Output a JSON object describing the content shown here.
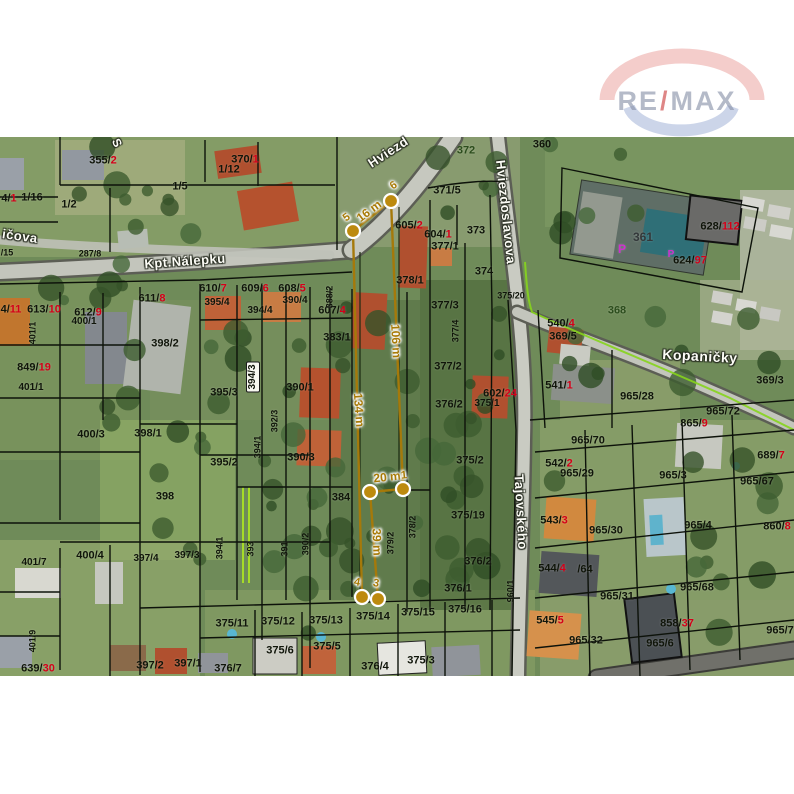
{
  "watermark": {
    "re": "RE",
    "slash": "/",
    "max": "MAX"
  },
  "map": {
    "street_labels": [
      {
        "t": "Kpt.Nálepku",
        "x": 185,
        "y": 261,
        "rot": -4,
        "fs": 13
      },
      {
        "t": "Hviezd",
        "x": 388,
        "y": 152,
        "rot": -33,
        "fs": 13
      },
      {
        "t": "Hviezdoslavova",
        "x": 506,
        "y": 212,
        "rot": 84,
        "fs": 13
      },
      {
        "t": "Tajovského",
        "x": 521,
        "y": 512,
        "rot": 87,
        "fs": 13
      },
      {
        "t": "Kopaničky",
        "x": 700,
        "y": 356,
        "rot": 3,
        "fs": 14
      },
      {
        "t": "ičova",
        "x": 20,
        "y": 236,
        "rot": 8,
        "fs": 13
      },
      {
        "t": "S",
        "x": 117,
        "y": 143,
        "rot": 65,
        "fs": 12
      }
    ],
    "parcel_labels": [
      {
        "t": "355/",
        "r": "2",
        "x": 103,
        "y": 161
      },
      {
        "t": "370/",
        "r": "1",
        "x": 245,
        "y": 160
      },
      {
        "t": "1/12",
        "x": 229,
        "y": 170
      },
      {
        "t": "1/5",
        "x": 180,
        "y": 187
      },
      {
        "t": "4/",
        "r": "1",
        "x": 9,
        "y": 199
      },
      {
        "t": "1/16",
        "x": 32,
        "y": 198
      },
      {
        "t": "1/2",
        "x": 69,
        "y": 205
      },
      {
        "t": "287/8",
        "x": 90,
        "y": 254,
        "fs": 9
      },
      {
        "t": "/15",
        "x": 7,
        "y": 253,
        "fs": 9
      },
      {
        "t": "611/",
        "r": "8",
        "x": 152,
        "y": 299
      },
      {
        "t": "610/",
        "r": "7",
        "x": 213,
        "y": 289
      },
      {
        "t": "609/",
        "r": "6",
        "x": 255,
        "y": 289
      },
      {
        "t": "608/",
        "r": "5",
        "x": 292,
        "y": 289
      },
      {
        "t": "395/4",
        "x": 217,
        "y": 303,
        "fs": 10
      },
      {
        "t": "390/4",
        "x": 295,
        "y": 301,
        "fs": 10
      },
      {
        "t": "394/4",
        "x": 260,
        "y": 311,
        "fs": 10
      },
      {
        "t": "607/",
        "r": "4",
        "x": 332,
        "y": 311
      },
      {
        "t": "388/2",
        "x": 330,
        "y": 297,
        "v": true,
        "fs": 9
      },
      {
        "t": "383/1",
        "x": 337,
        "y": 338
      },
      {
        "t": "4/",
        "r": "11",
        "x": 11,
        "y": 310
      },
      {
        "t": "613/",
        "r": "10",
        "x": 44,
        "y": 310
      },
      {
        "t": "612/",
        "r": "9",
        "x": 88,
        "y": 313
      },
      {
        "t": "400/1",
        "x": 84,
        "y": 322,
        "fs": 10
      },
      {
        "t": "401/1",
        "x": 33,
        "y": 333,
        "v": true,
        "fs": 9
      },
      {
        "t": "849/",
        "r": "19",
        "x": 34,
        "y": 368
      },
      {
        "t": "401/1",
        "x": 31,
        "y": 388,
        "fs": 10
      },
      {
        "t": "398/2",
        "x": 165,
        "y": 344
      },
      {
        "t": "398/1",
        "x": 148,
        "y": 434
      },
      {
        "t": "395/3",
        "x": 224,
        "y": 393
      },
      {
        "t": "394/3",
        "x": 253,
        "y": 377,
        "v": true,
        "box": true,
        "fs": 10
      },
      {
        "t": "390/1",
        "x": 300,
        "y": 388
      },
      {
        "t": "392/3",
        "x": 275,
        "y": 421,
        "v": true,
        "fs": 9
      },
      {
        "t": "394/1",
        "x": 258,
        "y": 447,
        "v": true,
        "fs": 9
      },
      {
        "t": "395/2",
        "x": 224,
        "y": 463
      },
      {
        "t": "390/3",
        "x": 301,
        "y": 458
      },
      {
        "t": "384",
        "x": 341,
        "y": 498
      },
      {
        "t": "398",
        "x": 165,
        "y": 497
      },
      {
        "t": "400/3",
        "x": 91,
        "y": 435
      },
      {
        "t": "400/4",
        "x": 90,
        "y": 556
      },
      {
        "t": "397/4",
        "x": 146,
        "y": 559,
        "fs": 10
      },
      {
        "t": "397/3",
        "x": 187,
        "y": 556,
        "fs": 10
      },
      {
        "t": "394/1",
        "x": 220,
        "y": 548,
        "v": true,
        "fs": 9
      },
      {
        "t": "393",
        "x": 251,
        "y": 549,
        "v": true,
        "fs": 9
      },
      {
        "t": "391",
        "x": 285,
        "y": 549,
        "v": true,
        "fs": 9
      },
      {
        "t": "390/2",
        "x": 306,
        "y": 544,
        "v": true,
        "fs": 9
      },
      {
        "t": "401/7",
        "x": 34,
        "y": 563,
        "fs": 10
      },
      {
        "t": "401/9",
        "x": 33,
        "y": 641,
        "v": true,
        "fs": 9
      },
      {
        "t": "639/",
        "r": "30",
        "x": 38,
        "y": 669
      },
      {
        "t": "397/2",
        "x": 150,
        "y": 666
      },
      {
        "t": "397/1",
        "x": 188,
        "y": 664
      },
      {
        "t": "375/11",
        "x": 232,
        "y": 624
      },
      {
        "t": "375/12",
        "x": 278,
        "y": 622
      },
      {
        "t": "375/13",
        "x": 326,
        "y": 621
      },
      {
        "t": "375/14",
        "x": 373,
        "y": 617
      },
      {
        "t": "375/15",
        "x": 418,
        "y": 613
      },
      {
        "t": "375/16",
        "x": 465,
        "y": 610
      },
      {
        "t": "375/6",
        "x": 280,
        "y": 651
      },
      {
        "t": "375/5",
        "x": 327,
        "y": 647
      },
      {
        "t": "375/3",
        "x": 421,
        "y": 661
      },
      {
        "t": "376/4",
        "x": 375,
        "y": 667
      },
      {
        "t": "376/7",
        "x": 228,
        "y": 669
      },
      {
        "t": "372",
        "x": 466,
        "y": 151,
        "c": "#2c4d1d"
      },
      {
        "t": "371/5",
        "x": 447,
        "y": 191
      },
      {
        "t": "605/",
        "r": "2",
        "x": 409,
        "y": 226
      },
      {
        "t": "604/",
        "r": "1",
        "x": 438,
        "y": 235
      },
      {
        "t": "373",
        "x": 476,
        "y": 231
      },
      {
        "t": "377/1",
        "x": 445,
        "y": 247
      },
      {
        "t": "374",
        "x": 484,
        "y": 272
      },
      {
        "t": "378/1",
        "x": 410,
        "y": 281
      },
      {
        "t": "377/3",
        "x": 445,
        "y": 306
      },
      {
        "t": "377/4",
        "x": 456,
        "y": 331,
        "v": true,
        "fs": 9
      },
      {
        "t": "375/20",
        "x": 511,
        "y": 296,
        "fs": 9
      },
      {
        "t": "377/2",
        "x": 448,
        "y": 367
      },
      {
        "t": "376/2",
        "x": 449,
        "y": 405
      },
      {
        "t": "602/",
        "r": "24",
        "x": 500,
        "y": 394
      },
      {
        "t": "375/1",
        "x": 487,
        "y": 404,
        "fs": 10
      },
      {
        "t": "375/2",
        "x": 470,
        "y": 461
      },
      {
        "t": "375/19",
        "x": 468,
        "y": 516
      },
      {
        "t": "378/2",
        "x": 413,
        "y": 527,
        "v": true,
        "fs": 9
      },
      {
        "t": "379/2",
        "x": 391,
        "y": 543,
        "v": true,
        "fs": 9
      },
      {
        "t": "376/2",
        "x": 478,
        "y": 562
      },
      {
        "t": "376/1",
        "x": 458,
        "y": 589
      },
      {
        "t": "960/1",
        "x": 511,
        "y": 591,
        "v": true,
        "fs": 9
      },
      {
        "t": "360",
        "x": 542,
        "y": 145
      },
      {
        "t": "361",
        "x": 643,
        "y": 237,
        "c": "#33383a",
        "fs": 12
      },
      {
        "t": "P",
        "x": 622,
        "y": 249,
        "c": "#cf2fcf",
        "fs": 12
      },
      {
        "t": "P",
        "x": 671,
        "y": 255,
        "c": "#cf2fcf",
        "fs": 10
      },
      {
        "t": "628/",
        "r": "112",
        "x": 720,
        "y": 227
      },
      {
        "t": "624/",
        "r": "97",
        "x": 690,
        "y": 261
      },
      {
        "t": "368",
        "x": 617,
        "y": 311,
        "c": "#2c4d1d"
      },
      {
        "t": "540/",
        "r": "4",
        "x": 561,
        "y": 324
      },
      {
        "t": "369/5",
        "x": 563,
        "y": 337
      },
      {
        "t": "369/3",
        "x": 770,
        "y": 381
      },
      {
        "t": "541/",
        "r": "1",
        "x": 559,
        "y": 386
      },
      {
        "t": "965/28",
        "x": 637,
        "y": 397
      },
      {
        "t": "965/72",
        "x": 723,
        "y": 412
      },
      {
        "t": "865/",
        "r": "9",
        "x": 694,
        "y": 424
      },
      {
        "t": "965/70",
        "x": 588,
        "y": 441
      },
      {
        "t": "689/",
        "r": "7",
        "x": 771,
        "y": 456
      },
      {
        "t": "542/",
        "r": "2",
        "x": 559,
        "y": 464
      },
      {
        "t": "965/29",
        "x": 577,
        "y": 474
      },
      {
        "t": "965/3",
        "x": 673,
        "y": 476
      },
      {
        "t": "965/67",
        "x": 757,
        "y": 482
      },
      {
        "t": "543/",
        "r": "3",
        "x": 554,
        "y": 521
      },
      {
        "t": "965/30",
        "x": 606,
        "y": 531
      },
      {
        "t": "965/4",
        "x": 698,
        "y": 526
      },
      {
        "t": "860/",
        "r": "8",
        "x": 777,
        "y": 527
      },
      {
        "t": "544/",
        "r": "4",
        "x": 552,
        "y": 569
      },
      {
        "t": "/64",
        "x": 585,
        "y": 570
      },
      {
        "t": "965/31",
        "x": 617,
        "y": 597
      },
      {
        "t": "965/68",
        "x": 697,
        "y": 588
      },
      {
        "t": "545/",
        "r": "5",
        "x": 550,
        "y": 621
      },
      {
        "t": "965/32",
        "x": 586,
        "y": 641
      },
      {
        "t": "858/",
        "r": "37",
        "x": 677,
        "y": 624
      },
      {
        "t": "965/6",
        "x": 660,
        "y": 644
      },
      {
        "t": "965/7",
        "x": 780,
        "y": 631
      }
    ],
    "measure": {
      "line_color": "#a5790a",
      "point_color": "#bd8a0e",
      "vertices": [
        {
          "n": "5",
          "x": 353,
          "y": 231
        },
        {
          "n": "6",
          "x": 391,
          "y": 201
        },
        {
          "n": "1",
          "x": 403,
          "y": 489
        },
        {
          "n": "2",
          "x": 370,
          "y": 492
        },
        {
          "n": "3",
          "x": 378,
          "y": 599
        },
        {
          "n": "4",
          "x": 362,
          "y": 597
        }
      ],
      "segments": [
        [
          "5",
          "6"
        ],
        [
          "6",
          "1"
        ],
        [
          "1",
          "2"
        ],
        [
          "2",
          "3"
        ],
        [
          "3",
          "4"
        ],
        [
          "4",
          "5"
        ]
      ],
      "labels": [
        {
          "t": "16 m",
          "x": 369,
          "y": 211,
          "rot": -37,
          "fs": 12
        },
        {
          "t": "106 m",
          "x": 396,
          "y": 341,
          "rot": 87,
          "fs": 12
        },
        {
          "t": "134 m",
          "x": 359,
          "y": 410,
          "rot": 86,
          "fs": 12
        },
        {
          "t": "20 m",
          "x": 387,
          "y": 477,
          "rot": -6,
          "fs": 12
        },
        {
          "t": "39 m",
          "x": 377,
          "y": 542,
          "rot": 88,
          "fs": 12
        }
      ],
      "point_labels": [
        {
          "t": "6",
          "x": 394,
          "y": 186,
          "rot": -35,
          "fs": 11
        },
        {
          "t": "5",
          "x": 347,
          "y": 218,
          "rot": -35,
          "fs": 11
        },
        {
          "t": "1",
          "x": 404,
          "y": 476,
          "rot": -6,
          "fs": 11
        },
        {
          "t": "4",
          "x": 357,
          "y": 583,
          "rot": 10,
          "fs": 11
        },
        {
          "t": "3",
          "x": 376,
          "y": 584,
          "rot": 10,
          "fs": 11
        }
      ]
    }
  }
}
